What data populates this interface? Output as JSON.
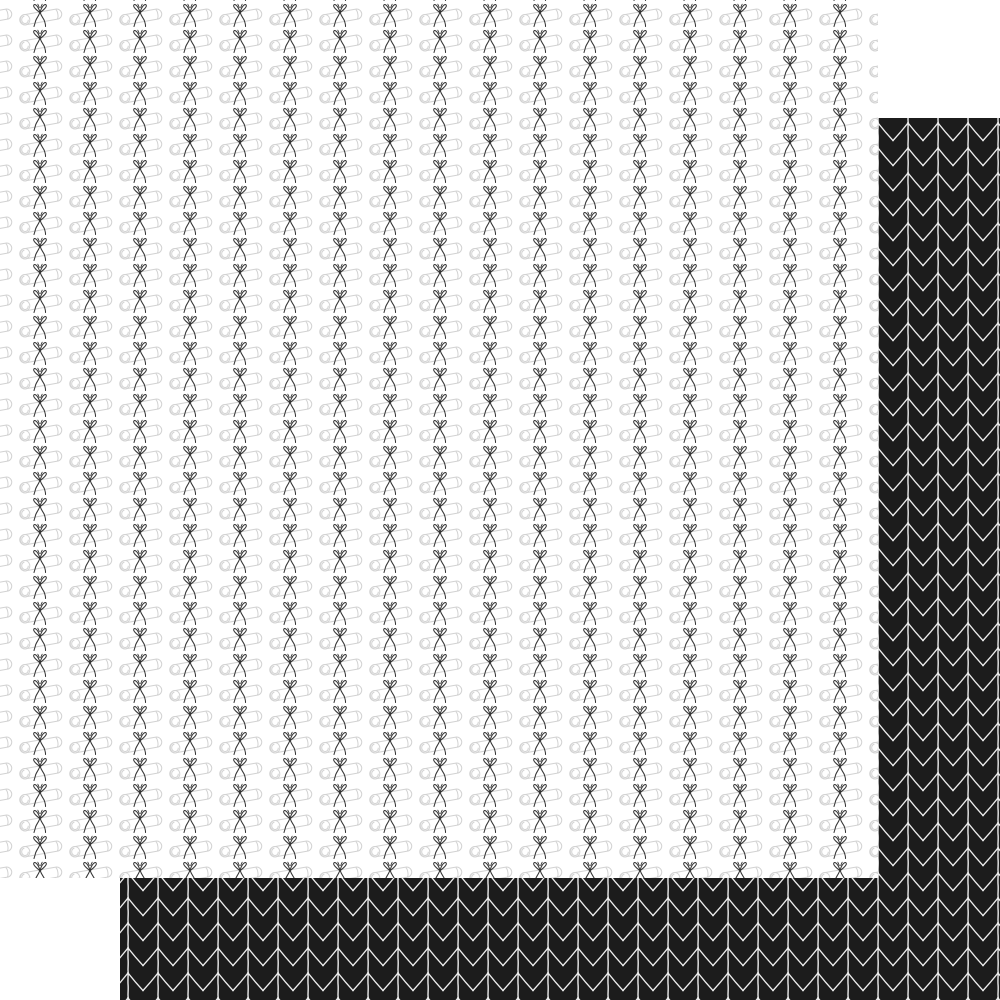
{
  "image": {
    "type": "double-sided scrapbook paper swatch, no text",
    "width": 1000,
    "height": 1000,
    "background_color": "#ffffff"
  },
  "front_sheet": {
    "description": "white paper, A-side: rows of rolled diploma scrolls tied with black ribbon bows",
    "x": 0,
    "y": 0,
    "width": 878,
    "height": 878,
    "background_color": "#ffffff",
    "pattern": {
      "name": "diploma-scroll-bows",
      "tile_width": 50,
      "tile_height": 26,
      "tile_offset_x": 15,
      "tile_offset_y": 1,
      "scroll_outline_color": "#d2d2d2",
      "scroll_fill_color": "#ffffff",
      "scroll_tilt_deg": -10,
      "bow_color": "#2b2b2b"
    }
  },
  "back_sheet": {
    "description": "black paper, B-side: white hand-drawn chevron arrows with vertical stems",
    "x": 120,
    "y": 118,
    "width": 880,
    "height": 882,
    "background_color": "#1c1c1c",
    "pattern": {
      "name": "chevron-arrows",
      "tile_width": 30,
      "tile_height": 25,
      "tile_offset_x": 23,
      "tile_offset_y": 20,
      "line_color": "#ededed",
      "chevron_amplitude": 17.5
    }
  }
}
